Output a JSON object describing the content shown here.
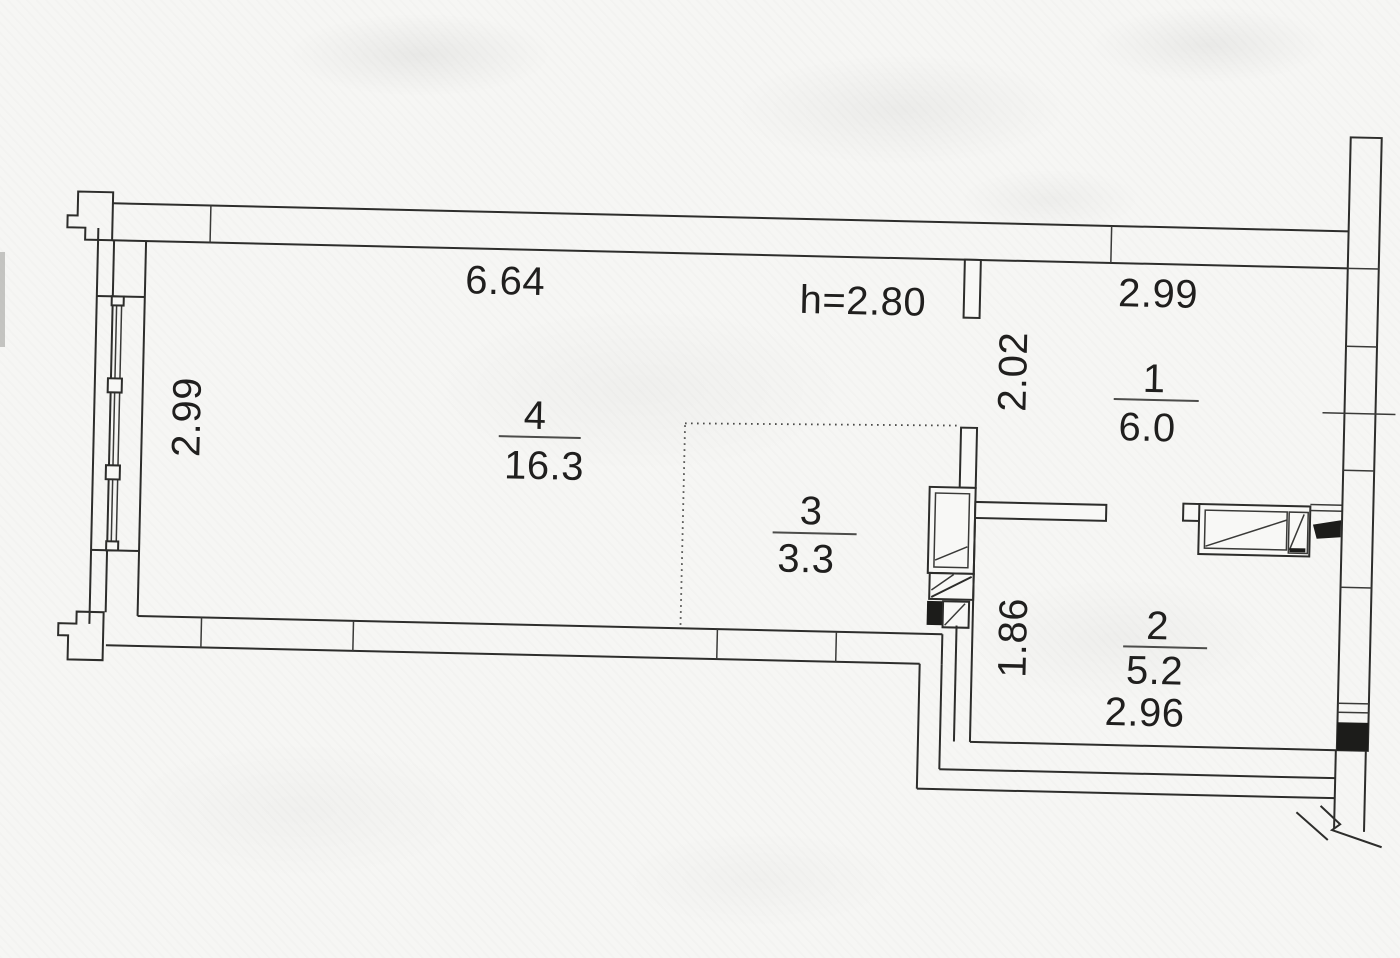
{
  "plan": {
    "paper_color": "#f6f6f4",
    "ink_color": "#2d2d2b",
    "rooms": [
      {
        "number": "1",
        "area": "6.0"
      },
      {
        "number": "2",
        "area": "5.2"
      },
      {
        "number": "3",
        "area": "3.3"
      },
      {
        "number": "4",
        "area": "16.3"
      }
    ],
    "dimensions": {
      "main_width": "6.64",
      "ceiling_height": "h=2.80",
      "room1_width": "2.99",
      "room1_depth": "2.02",
      "left_side": "2.99",
      "room2_depth": "1.86",
      "room2_width": "2.96"
    }
  }
}
